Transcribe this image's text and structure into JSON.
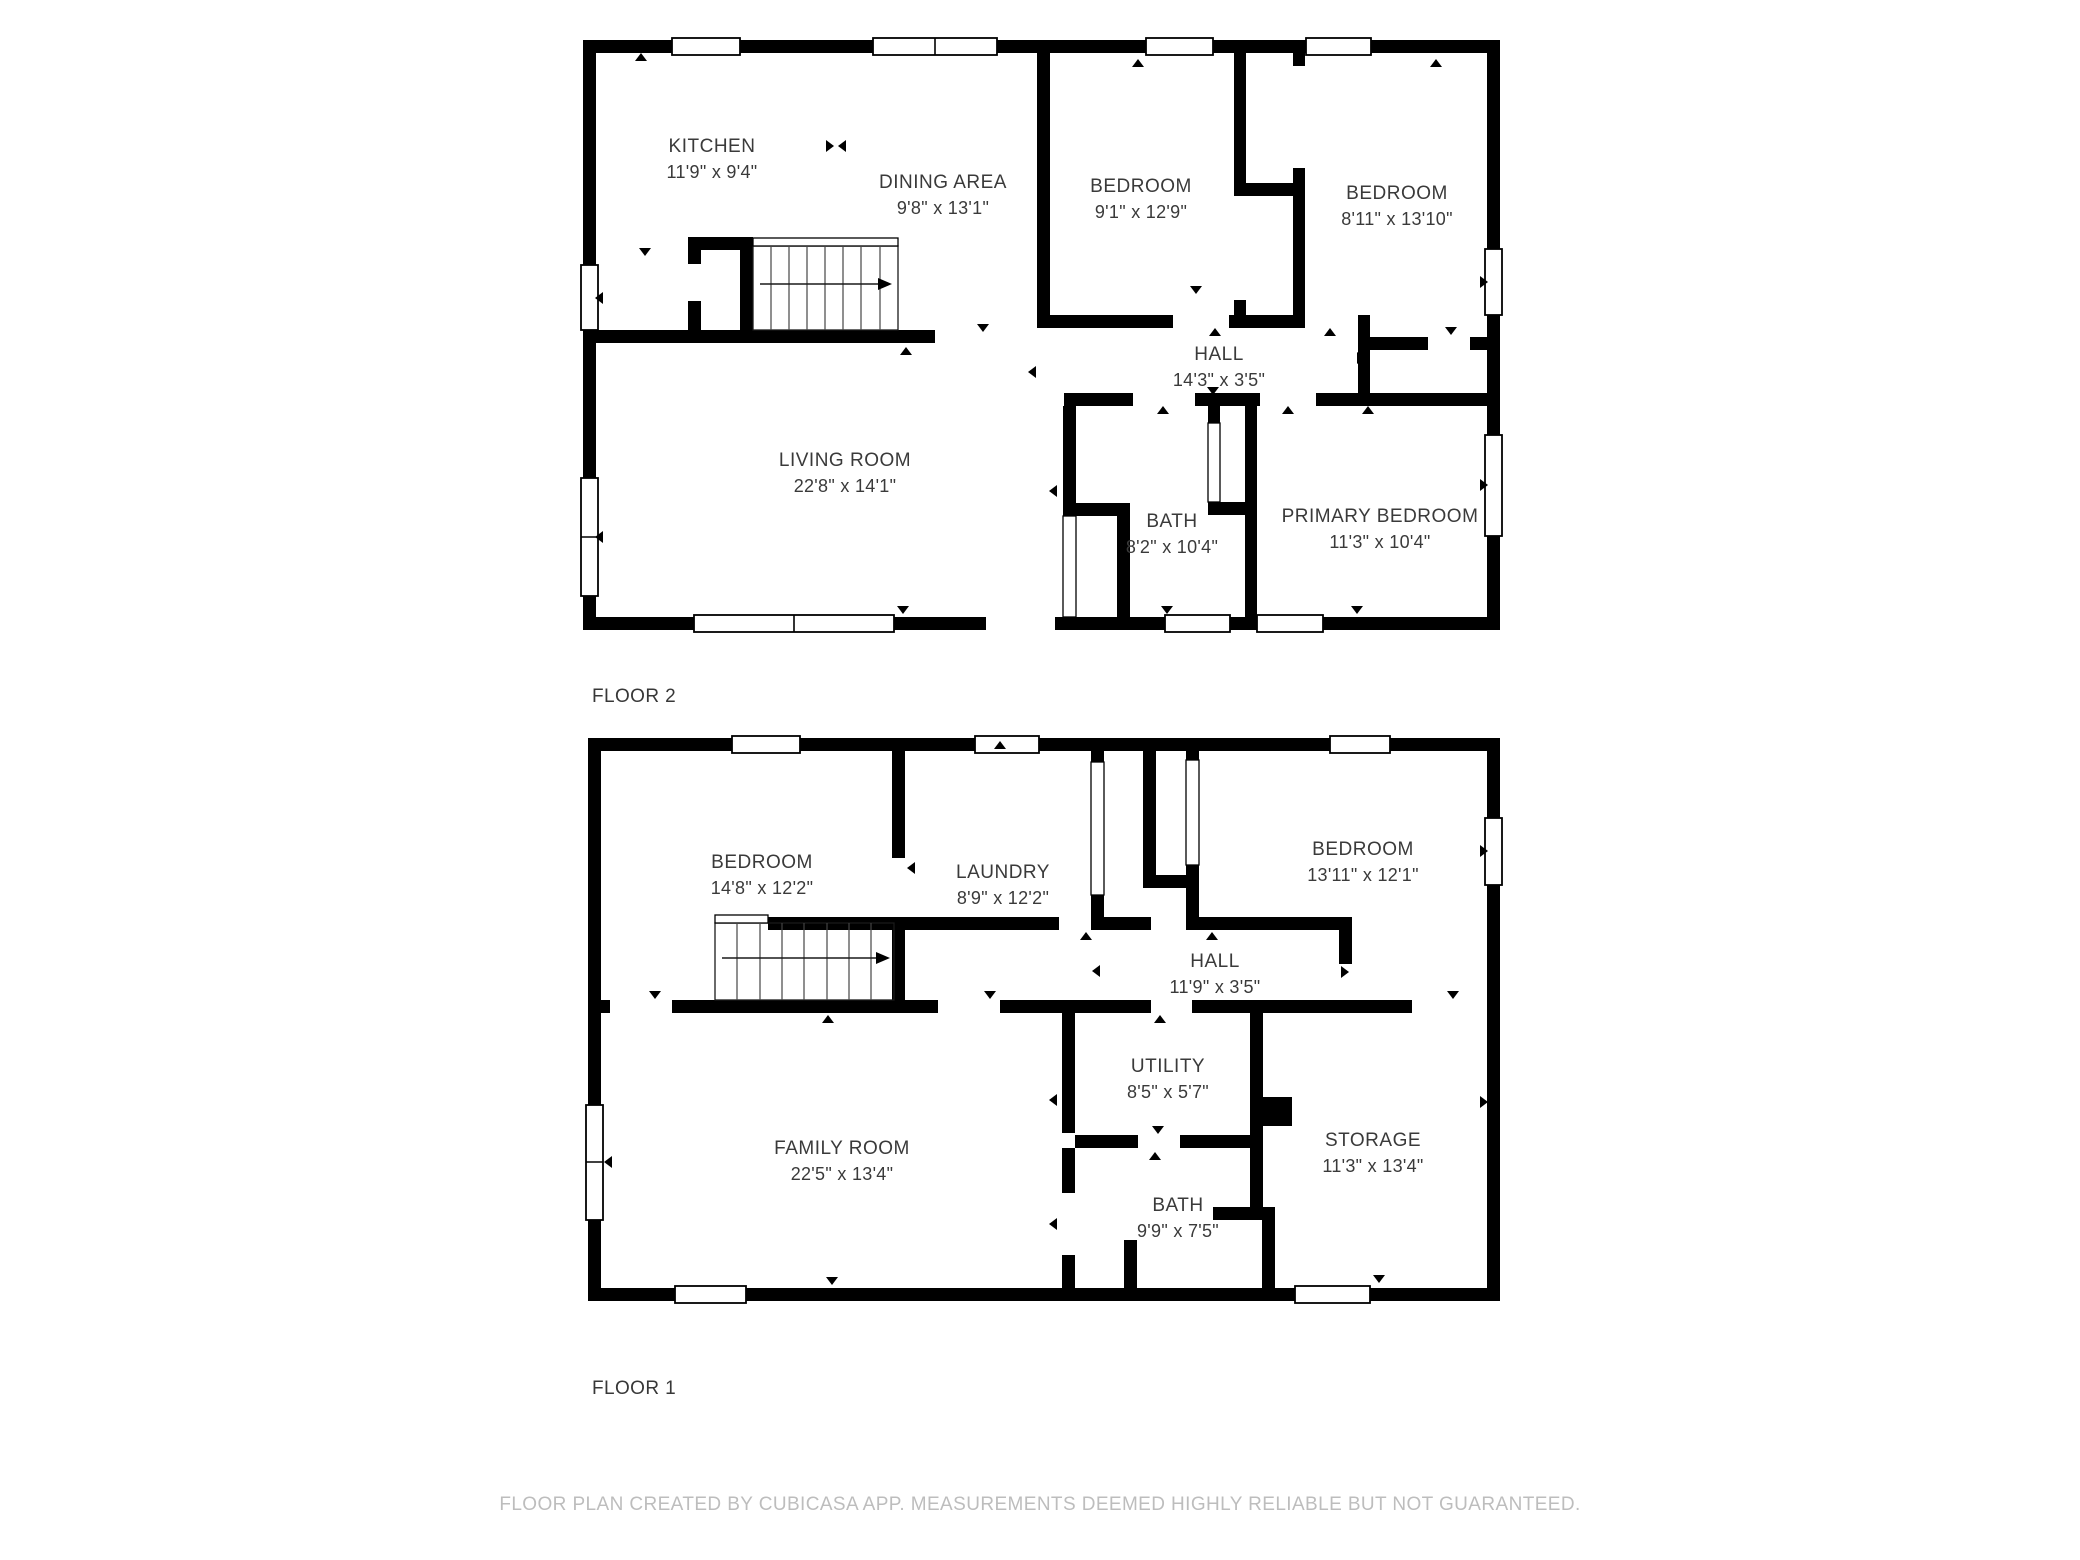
{
  "colors": {
    "wall": "#000000",
    "label_text": "#3a3a3a",
    "footer_text": "#bdbdbd"
  },
  "footer_text": "FLOOR PLAN CREATED BY CUBICASA APP. MEASUREMENTS DEEMED HIGHLY RELIABLE BUT NOT GUARANTEED.",
  "floors": [
    {
      "label": "FLOOR 2",
      "rooms": [
        {
          "name": "KITCHEN",
          "dims": "11'9\" x 9'4\""
        },
        {
          "name": "DINING AREA",
          "dims": "9'8\" x 13'1\""
        },
        {
          "name": "BEDROOM",
          "dims": "9'1\" x 12'9\""
        },
        {
          "name": "BEDROOM",
          "dims": "8'11\" x 13'10\""
        },
        {
          "name": "HALL",
          "dims": "14'3\" x 3'5\""
        },
        {
          "name": "LIVING ROOM",
          "dims": "22'8\" x 14'1\""
        },
        {
          "name": "BATH",
          "dims": "8'2\" x 10'4\""
        },
        {
          "name": "PRIMARY BEDROOM",
          "dims": "11'3\" x 10'4\""
        }
      ]
    },
    {
      "label": "FLOOR 1",
      "rooms": [
        {
          "name": "BEDROOM",
          "dims": "14'8\" x 12'2\""
        },
        {
          "name": "LAUNDRY",
          "dims": "8'9\" x 12'2\""
        },
        {
          "name": "BEDROOM",
          "dims": "13'11\" x 12'1\""
        },
        {
          "name": "HALL",
          "dims": "11'9\" x 3'5\""
        },
        {
          "name": "UTILITY",
          "dims": "8'5\" x 5'7\""
        },
        {
          "name": "FAMILY ROOM",
          "dims": "22'5\" x 13'4\""
        },
        {
          "name": "STORAGE",
          "dims": "11'3\" x 13'4\""
        },
        {
          "name": "BATH",
          "dims": "9'9\" x 7'5\""
        }
      ]
    }
  ]
}
